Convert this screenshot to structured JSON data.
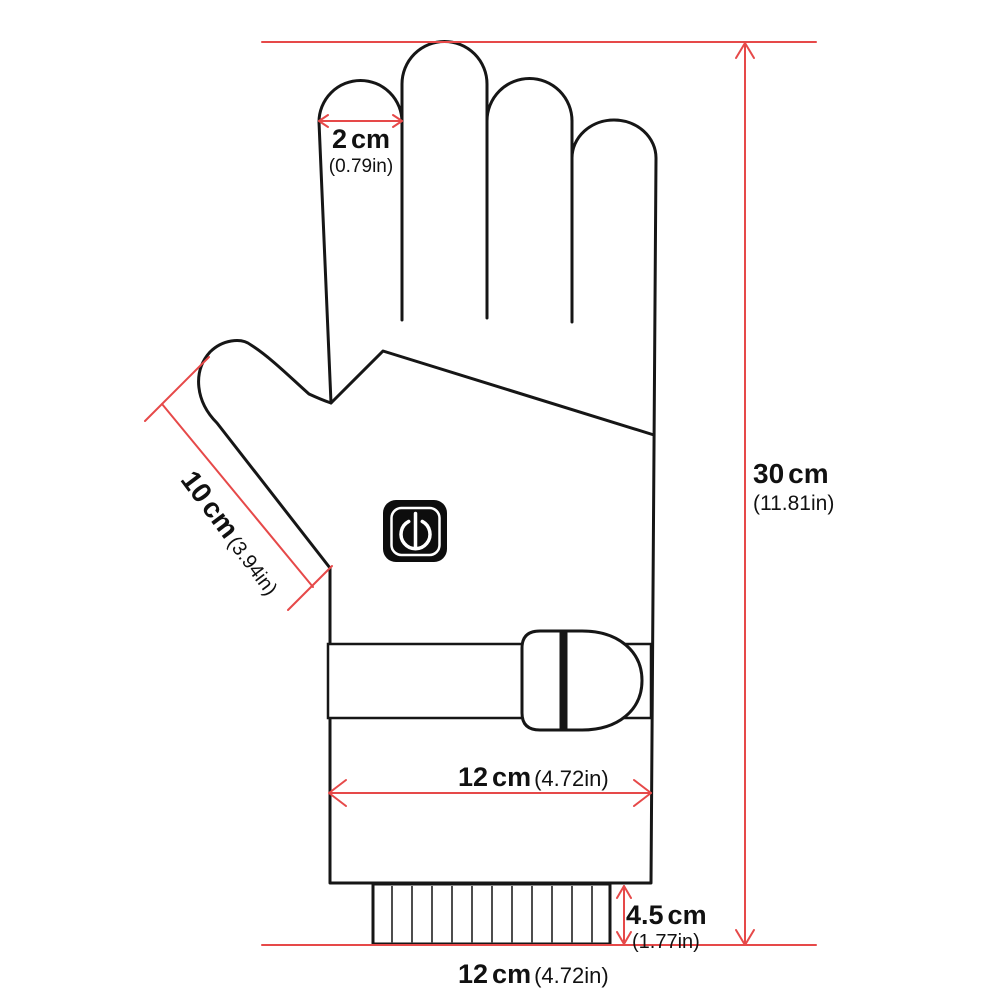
{
  "colors": {
    "dimension_red": "#e64949",
    "outline_black": "#161616",
    "button_black": "#0d0d0d",
    "rib_gray": "#4d4d4d"
  },
  "labels": {
    "finger_width": {
      "number": "2",
      "unit": "cm",
      "inches": "(0.79in)"
    },
    "thumb_length": {
      "number": "10",
      "unit": "cm",
      "inches": "(3.94in)"
    },
    "glove_height": {
      "number": "30",
      "unit": "cm",
      "inches": "(11.81in)"
    },
    "palm_width": {
      "number": "12",
      "unit": "cm",
      "inches": "(4.72in)"
    },
    "cuff_height": {
      "number": "4.5",
      "unit": "cm",
      "inches": "(1.77in)"
    },
    "glove_width": {
      "number": "12",
      "unit": "cm",
      "inches": "(4.72in)"
    }
  },
  "icons": {
    "power_button": "power-icon"
  }
}
